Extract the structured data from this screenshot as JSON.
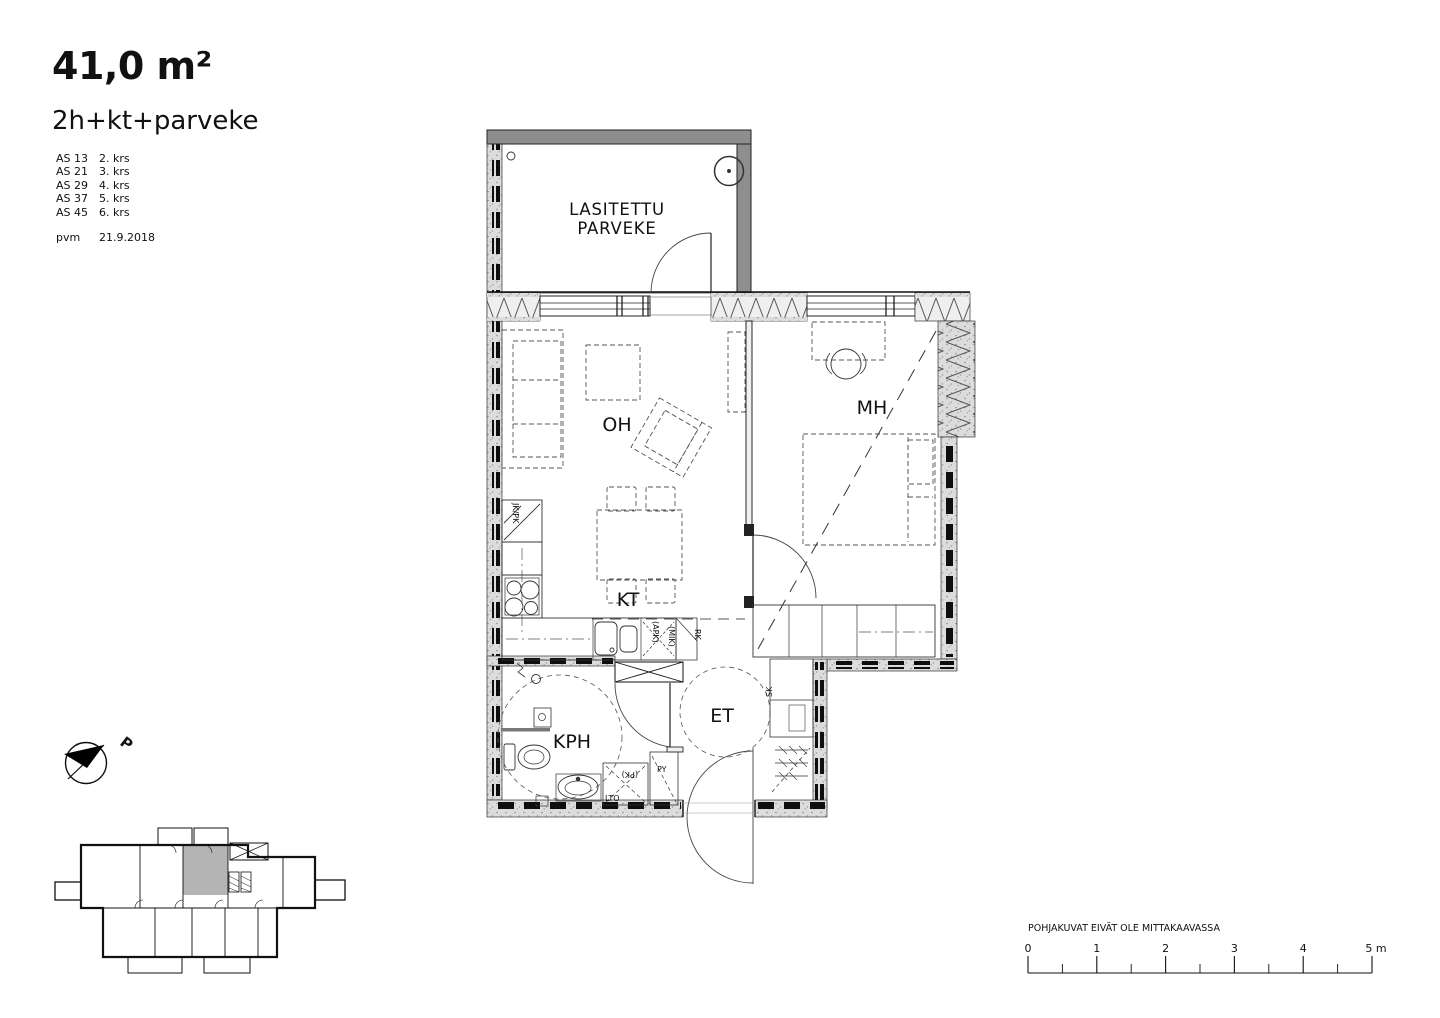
{
  "header": {
    "area": "41,0 m²",
    "type": "2h+kt+parveke",
    "units": [
      {
        "id": "AS 13",
        "floor": "2. krs"
      },
      {
        "id": "AS 21",
        "floor": "3. krs"
      },
      {
        "id": "AS 29",
        "floor": "4. krs"
      },
      {
        "id": "AS 37",
        "floor": "5. krs"
      },
      {
        "id": "AS 45",
        "floor": "6. krs"
      }
    ],
    "pvm_label": "pvm",
    "date": "21.9.2018"
  },
  "plan": {
    "balcony_line1": "LASITETTU",
    "balcony_line2": "PARVEKE",
    "rooms": {
      "oh": "OH",
      "mh": "MH",
      "kt": "KT",
      "kph": "KPH",
      "et": "ET"
    },
    "labels": {
      "jkpk": "JK/PK",
      "apk": "(APK)",
      "mik": "(MIK)",
      "rk": "RK",
      "sk": "SK",
      "pk": "(PK)",
      "py": "PY",
      "lto": "LTO"
    }
  },
  "compass": {
    "north": "P"
  },
  "footer": {
    "disclaimer": "POHJAKUVAT EIVÄT OLE MITTAKAAVASSA",
    "ticks": [
      "0",
      "1",
      "2",
      "3",
      "4",
      "5 m"
    ]
  },
  "colors": {
    "highlight_unit": "#b4b4b4",
    "line": "#111111",
    "wall_fill": "#dcdcdc"
  }
}
